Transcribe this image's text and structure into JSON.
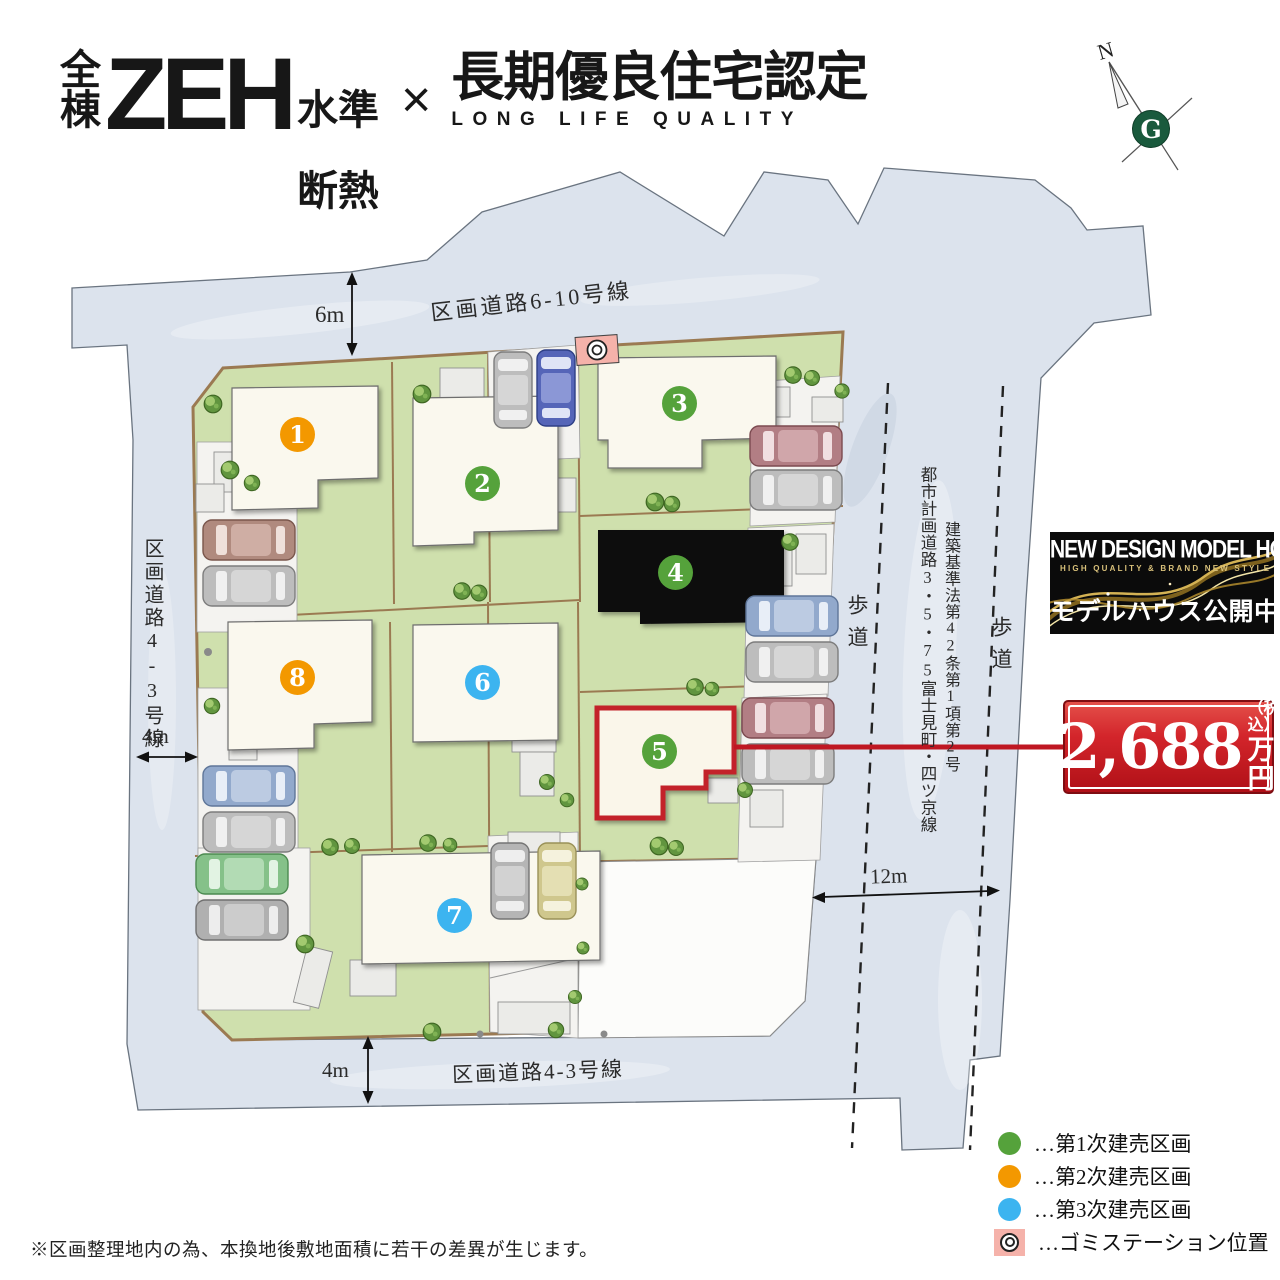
{
  "header": {
    "all_units": "全\n棟",
    "zeh": "ZEH",
    "level1": "水準",
    "level2": "断熱",
    "multiply": "×",
    "title": "長期優良住宅認定",
    "subtitle": "LONG LIFE QUALITY"
  },
  "compass": {
    "north": "N",
    "logo": "G"
  },
  "map": {
    "roads": {
      "top_name": "区画道路6-10号線",
      "top_width": "6m",
      "left_name": "区画道路4-3号線",
      "left_width": "4m",
      "bottom_name": "区画道路4-3号線",
      "bottom_width": "4m",
      "right_width": "12m",
      "planning_road": "都市計画道路3・5・75富士見町・四ツ京線",
      "building_law": "建築基準法第42条第1項第2号",
      "sidewalk_left": "歩道",
      "sidewalk_right": "歩道"
    },
    "lots": [
      {
        "number": "1",
        "color": "#f39800"
      },
      {
        "number": "2",
        "color": "#55a23b"
      },
      {
        "number": "3",
        "color": "#55a23b"
      },
      {
        "number": "4",
        "color": "#55a23b"
      },
      {
        "number": "5",
        "color": "#55a23b"
      },
      {
        "number": "6",
        "color": "#3cb4f0"
      },
      {
        "number": "7",
        "color": "#3cb4f0"
      },
      {
        "number": "8",
        "color": "#f39800"
      }
    ]
  },
  "price_tag": {
    "amount": "2,688",
    "tax_note": "（税込）",
    "unit": "万円"
  },
  "model_house": {
    "title": "NEW DESIGN MODEL HOUSE",
    "tagline": "HIGH QUALITY & BRAND NEW STYLE",
    "status": "モデルハウス公開中"
  },
  "legend": [
    {
      "label": "…第1次建売区画",
      "color": "#55a23b"
    },
    {
      "label": "…第2次建売区画",
      "color": "#f39800"
    },
    {
      "label": "…第3次建売区画",
      "color": "#3cb4f0"
    },
    {
      "label": "…ゴミステーション位置",
      "color": "#f5b2aa"
    }
  ],
  "footnote": "※区画整理地内の為、本換地後敷地面積に若干の差異が生じます。"
}
